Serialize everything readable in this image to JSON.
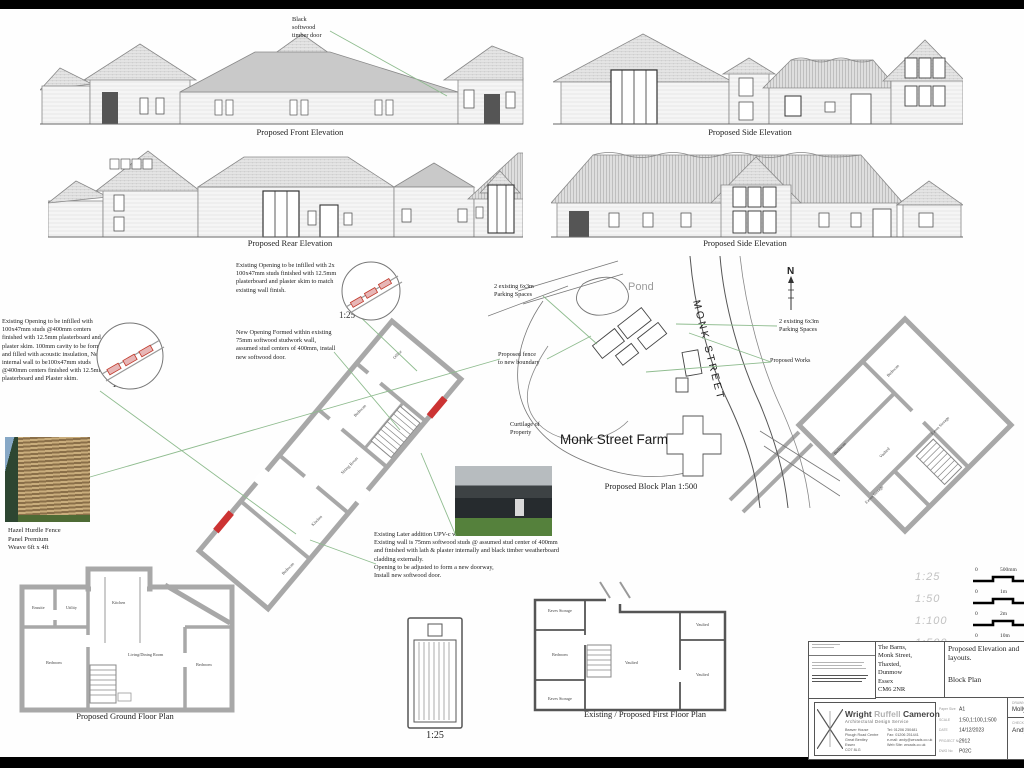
{
  "annotations": {
    "black_door": "Black\nsoftwood\ntimber door",
    "note1": "Existing Opening to be infilled with 100x47mm studs @400mm centers finished with 12.5mm plasterboard and plaster skim. 100mm cavity to be formed and filled with acoustic insulation, New internal wall to be100x47mm studs @400mm centers finished with 12.5mm plasterboard and Plaster skim.",
    "note1_scale": "1:25",
    "note2": "Existing Opening to be infilled with 2x 100x47mm studs finished with 12.5mm plasterboard and plaster skim to match existing wall finish.",
    "note2_scale": "1:25",
    "note3": "New Opening Formed within existing 75mm softwood studwork wall, assumed stud centers of 400mm, install new softwood door.",
    "note4": "Existing Later addition UPV-c window to be removed.\nExisting wall is 75mm softwood studs @ assumed stud center of 400mm and finished with lath & plaster internally and black timber weatherboard cladding externally.\nOpening to be adjusted to form a new doorway,\nInstall new softwood door."
  },
  "elevations": {
    "front": "Proposed Front Elevation",
    "side_a": "Proposed Side Elevation",
    "rear": "Proposed Rear Elevation",
    "side_b": "Proposed Side Elevation"
  },
  "fence": {
    "caption": "Hazel Hurdle Fence\nPanel Premium\nWeave 6ft x 4ft"
  },
  "block_plan": {
    "pond_label": "Pond",
    "street_label": "MONK STREET",
    "farm_label": "Monk Street Farm",
    "caption": "Proposed Block Plan 1:500",
    "curtilage_label": "Curtilage of\nProperty",
    "parking_left": "2 existing 6x3m\nParking Spaces",
    "parking_right": "2 existing 6x3m\nParking Spaces",
    "fence_label": "Proposed fence\nto new boundary",
    "works_label": "Proposed Works",
    "north_label": "N"
  },
  "plans": {
    "ground_caption": "Proposed Ground Floor Plan",
    "first_caption": "Existing / Proposed First Floor Plan",
    "door_detail_scale": "1:25",
    "wing_rooms": {
      "office": "Office",
      "bedroom_upper": "Bedroom",
      "sitting": "Sitting Room",
      "kitchen": "Kitchen",
      "bedroom_lower": "Bedroom"
    },
    "ground_rooms": {
      "ensuite": "Ensuite",
      "utility": "Utility",
      "kitchen": "Kitchen",
      "bedroom_left": "Bedroom",
      "living": "Living/Dining Room",
      "bedroom_right": "Bedroom"
    },
    "first_rooms": {
      "eaves_top": "Eaves Storage",
      "bedroom": "Bedroom",
      "eaves_bottom": "Eaves Storage",
      "vaulted_main": "Vaulted",
      "vaulted_top": "Vaulted",
      "vaulted_right": "Vaulted"
    },
    "upper_wing_rooms": {
      "bedroom_top": "Bedroom",
      "eaves_right": "Eaves Storage",
      "vaulted": "Vaulted",
      "bedroom_left": "Bedroom",
      "eaves_bottom": "Eaves Storage"
    }
  },
  "scale_bars": [
    {
      "ratio": "1:25",
      "zero": "0",
      "unit": "500mm"
    },
    {
      "ratio": "1:50",
      "zero": "0",
      "unit": "1m"
    },
    {
      "ratio": "1:100",
      "zero": "0",
      "unit": "2m"
    },
    {
      "ratio": "1:500",
      "zero": "0",
      "unit": "10m",
      "unit2": "2"
    }
  ],
  "title_block": {
    "address": "The Barns,\nMonk Street,\nThaxted,\nDunmow\nEssex\nCM6 2NR",
    "title_line1": "Proposed Elevation and layouts.",
    "title_line2": "Block Plan",
    "company_first": "Wright ",
    "company_mid": "Ruffell ",
    "company_last": "Cameron",
    "company_sub": "Architectural Design Service",
    "addr_left": "Beaver House\nPlough Road Centre\nGreat Bentley\nEssex\nCO7 8LG",
    "contact_right": "Tel: 01206 250481\nFax: 01206 251441\ne-mail: andy@wrcads.co.uk\nWeb Site: wrcads.co.uk",
    "fields": [
      {
        "label": "Paper Size",
        "value": "A1"
      },
      {
        "label": "SCALE",
        "value": "1:50,1:100,1:500"
      },
      {
        "label": "DATE",
        "value": "14/12/2023"
      },
      {
        "label": "PROJECT No",
        "value": "2912"
      },
      {
        "label": "DWG No",
        "value": "P02C"
      }
    ],
    "drawn_label": "DRAWN BY",
    "drawn_value": "Molly Bro",
    "checked_label": "CHECKED",
    "checked_value": "Andy Cam"
  }
}
